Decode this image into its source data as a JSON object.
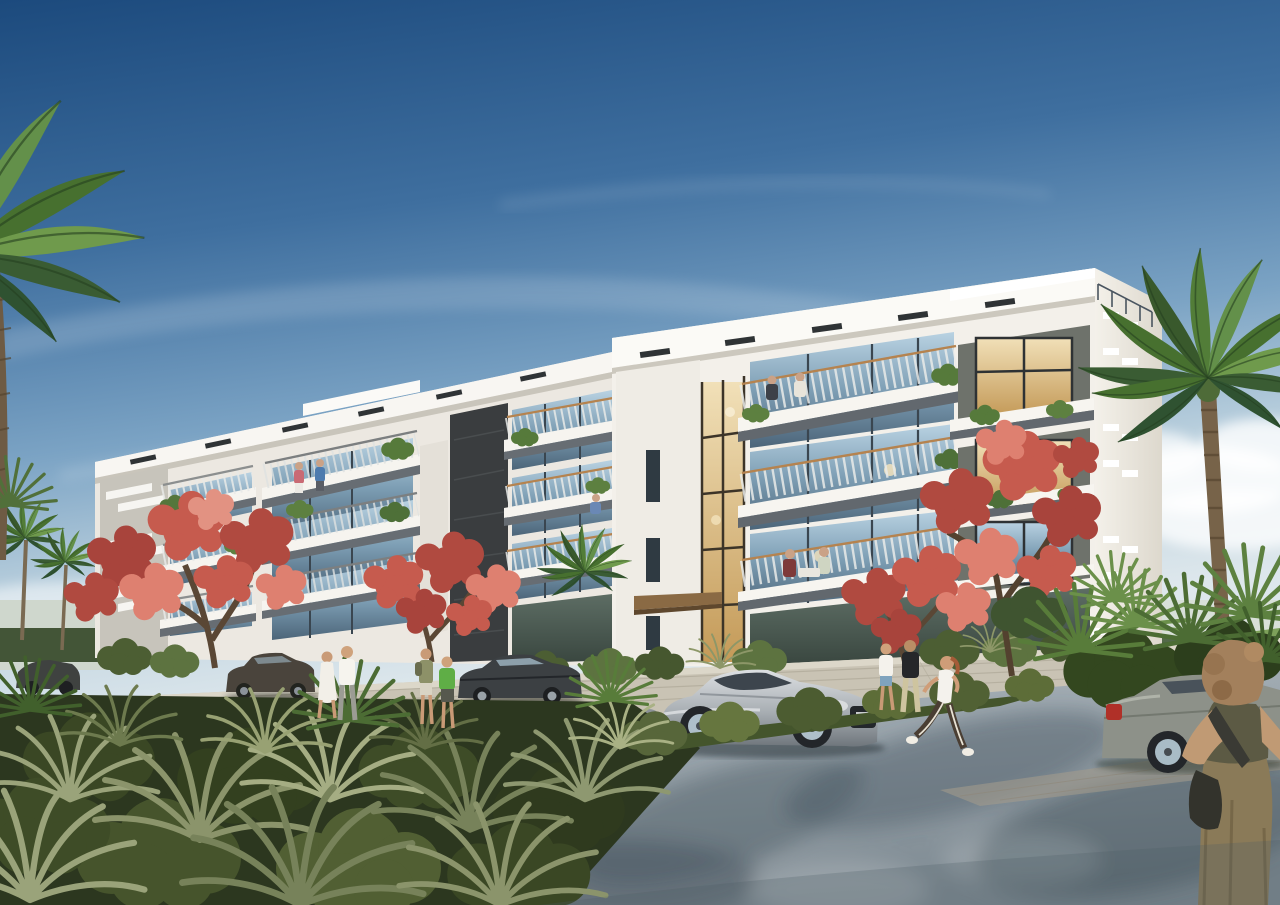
{
  "scene": {
    "alt": "Photorealistic architectural rendering of a long modern four-storey white apartment building with glass-railed balconies, seen at an angle under a clear blue sky, surrounded by palm trees, coral-red flowering trees, dense sage-green shrub beds, parked and passing cars, and pedestrians on a light grey road",
    "sky": {
      "top_color": "#1c4a7d",
      "mid_color": "#5e8cb4",
      "horizon_color": "#d9e4ea",
      "clouds": "thin wispy diagonal streaks high up, soft white cumulus near the right horizon"
    },
    "building": {
      "label": "four-storey modern apartment block",
      "floors": 4,
      "features": [
        "stepped white parapet and fascia bands with dark vent grilles",
        "projecting balconies with white slabs and dark grey fascias",
        "thin vertical baluster railings with wood handrails",
        "full-height glazed entrance strip with warm interior light",
        "charcoal stone accent wall strip",
        "louvered end panel",
        "rooftop guard rail at right corner",
        "balcony planters with trailing greenery",
        "residents relaxing on several balconies"
      ],
      "colors": {
        "sunlit_white": "#f5f3ee",
        "shaded_white": "#e9e6df",
        "balcony_fascia_grey": "#676d73",
        "stone_accent": "#3a3d3f",
        "window_glass": "#9fc0d4",
        "warm_interior": "#e7cf9f",
        "wood_canopy": "#8a6a44",
        "handrail_wood": "#b5834f"
      }
    },
    "vegetation": {
      "palms": "tall date palm overhanging the top-left corner, large date palm and fan-palm cluster at the right, smaller distant palms to the left of the building",
      "flowering_trees": "four coral-red royal poinciana trees in front of the facade",
      "foreground": "dense bed of spiky sage-green grasses and olive shrubs across the lower left",
      "colors": {
        "palm_dark": "#2f5231",
        "palm_light": "#6f9a4c",
        "flower_dark": "#a8443c",
        "flower_light": "#e08a76",
        "grass_sage": "#9aa37a",
        "bush_olive": "#57663a",
        "bed_dark": "#2c371f"
      }
    },
    "road": {
      "surface": "smooth light grey asphalt with dappled palm shadows and a paver kerb band",
      "colors": {
        "light": "#a3adb4",
        "shadow": "#55626b",
        "paver_sidewalk": "#c9c3b4"
      }
    },
    "vehicles": [
      {
        "label": "dark sedan far left, partly hidden by shrubs",
        "color": "#3f4240"
      },
      {
        "label": "dark bronze sedan parked by the left sidewalk",
        "color": "#4a443c"
      },
      {
        "label": "charcoal sedan parked at the centre kerb",
        "color": "#3c4043"
      },
      {
        "label": "silver coupe on the road facing right",
        "color": "#b9bdc1"
      },
      {
        "label": "sage-grey sedan at the right kerb with red tail light",
        "color": "#8d9189"
      }
    ],
    "people": [
      {
        "label": "woman in white dress and man in white shirt strolling on the sidewalk"
      },
      {
        "label": "two children, one in a green shirt, one with a backpack"
      },
      {
        "label": "couple walking near the entrance, man in black t-shirt"
      },
      {
        "label": "jogging woman in white tank top and dark track pants"
      },
      {
        "label": "woman with curly hair, olive top, khaki trousers and dark shoulder bag in the right foreground"
      },
      {
        "label": "small figures seated and standing on balconies"
      }
    ]
  }
}
